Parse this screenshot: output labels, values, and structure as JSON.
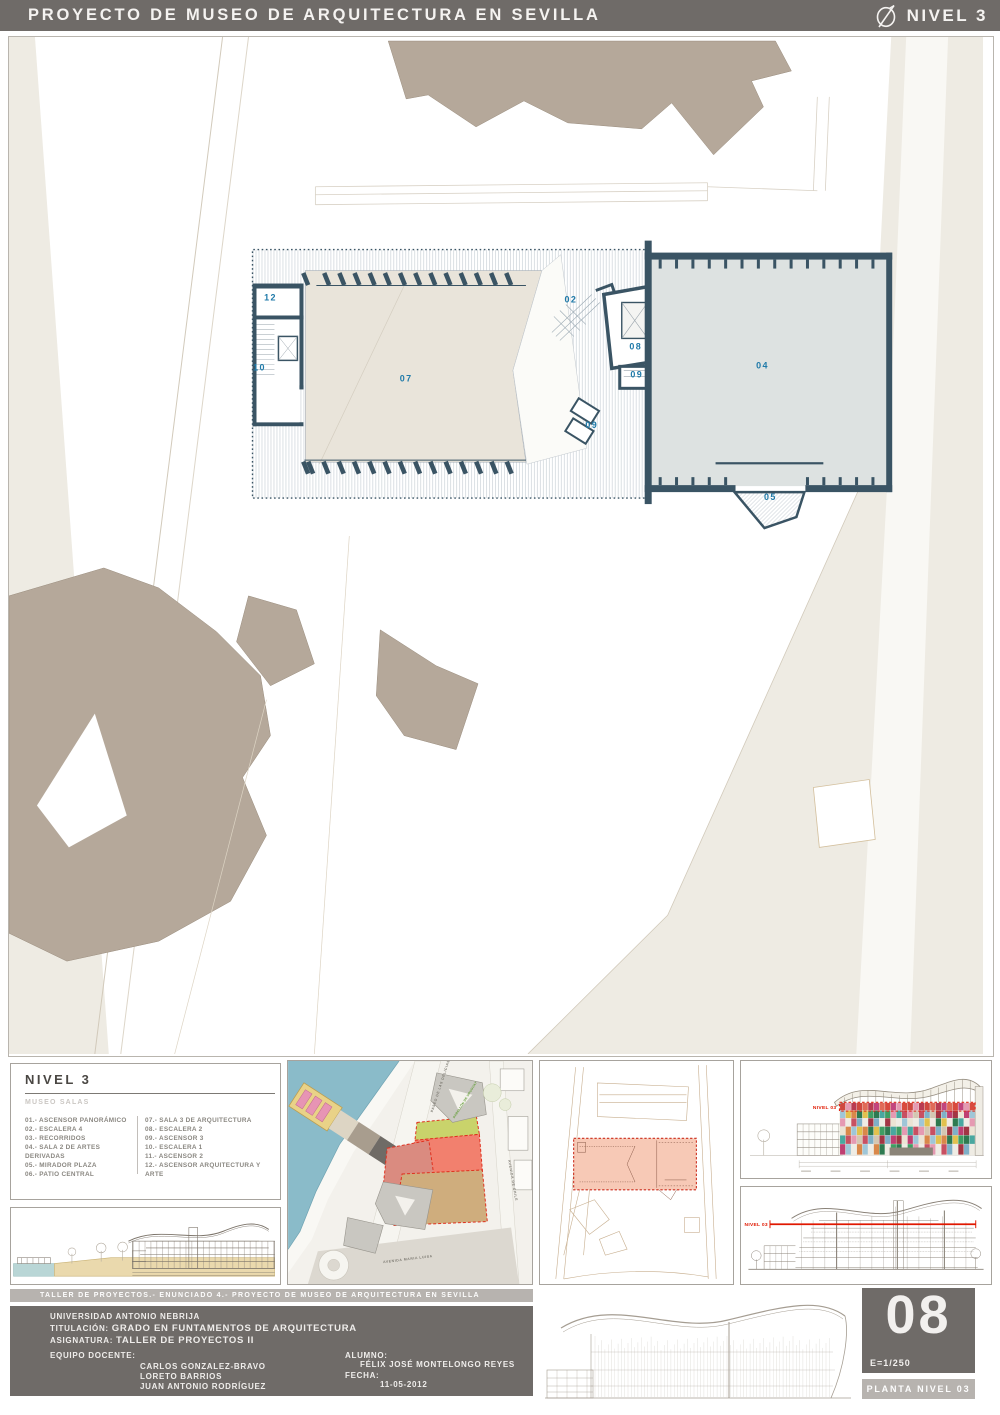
{
  "header": {
    "title": "PROYECTO DE MUSEO DE ARQUITECTURA EN SEVILLA",
    "level": "NIVEL 3"
  },
  "plan": {
    "room_labels": [
      {
        "t": "12",
        "x": 262,
        "y": 264
      },
      {
        "t": "10",
        "x": 251,
        "y": 334
      },
      {
        "t": "07",
        "x": 398,
        "y": 345
      },
      {
        "t": "02",
        "x": 563,
        "y": 266
      },
      {
        "t": "08",
        "x": 628,
        "y": 313
      },
      {
        "t": "09",
        "x": 629,
        "y": 341
      },
      {
        "t": "09",
        "x": 584,
        "y": 392
      },
      {
        "t": "04",
        "x": 755,
        "y": 332
      },
      {
        "t": "05",
        "x": 763,
        "y": 464
      }
    ]
  },
  "legend": {
    "title": "NIVEL 3",
    "subtitle": "MUSEO SALAS",
    "items_left": [
      "01.- ASCENSOR PANORÁMICO",
      "02.- ESCALERA 4",
      "03.- RECORRIDOS",
      "04.- SALA 2 DE ARTES DERIVADAS",
      "05.- MIRADOR PLAZA",
      "06.- PATIO CENTRAL"
    ],
    "items_right": [
      "07.- SALA 3 DE ARQUITECTURA",
      "08.- ESCALERA 2",
      "09.- ASCENSOR 3",
      "10.- ESCALERA 1",
      "11.- ASCENSOR 2",
      "12.- ASCENSOR ARQUITECTURA Y ARTE"
    ]
  },
  "map": {
    "streets": {
      "paseo": "PASEO DE LAS DELICIAS",
      "avenida_maria_luisa": "AVENIDA MARIA LUISA",
      "avenida_chile": "AVENIDA DE CHILE"
    },
    "building_label": "PABELLÓN DE URUGUAY"
  },
  "elevation_panel": {
    "level_marker": "NIVEL 03",
    "marker_color": "#e02818",
    "facade_palette": [
      "#c85062",
      "#e59ab2",
      "#49a8a0",
      "#3f9e63",
      "#2e7a50",
      "#e2c14e",
      "#d9884a",
      "#9fc6d8",
      "#ece4d4",
      "#bf3f72",
      "#a23644",
      "#7fb0c8",
      "#d4c7b2"
    ],
    "facade_top_palette": [
      "#cf4840",
      "#b93b52",
      "#e06a58",
      "#c2457e",
      "#d84a3e",
      "#e59ab2"
    ]
  },
  "section_panel": {
    "level_marker": "NIVEL 03",
    "marker_color": "#e01800"
  },
  "footer": {
    "strip_title": "TALLER DE PROYECTOS.- ENUNCIADO 4.- PROYECTO DE MUSEO DE ARQUITECTURA EN SEVILLA",
    "university": "UNIVERSIDAD ANTONIO NEBRIJA",
    "degree_label": "TITULACIÓN:",
    "degree": "GRADO EN FUNTAMENTOS DE ARQUITECTURA",
    "subject_label": "ASIGNATURA:",
    "subject": "TALLER DE PROYECTOS II",
    "team_label": "EQUIPO DOCENTE:",
    "team": [
      "CARLOS GONZALEZ-BRAVO",
      "LORETO BARRIOS",
      "JUAN ANTONIO RODRÍGUEZ"
    ],
    "student_label": "ALUMNO:",
    "student": "FÉLIX JOSÉ MONTELONGO REYES",
    "date_label": "FECHA:",
    "date": "11-05-2012",
    "sheet_number": "08",
    "scale": "E=1/250",
    "sheet_title": "PLANTA NIVEL 03"
  },
  "colors": {
    "wall": "#3a5464",
    "label_blue": "#1f7aa9",
    "room_fill": "#e9e4da",
    "hall_fill": "#dde2e1",
    "street_fill": "#eeebe3",
    "building_tan": "#b5a89a",
    "bar_dark": "#6f6b68",
    "bar_light": "#b7b3af",
    "ground": "#ead9ad",
    "water": "#8abbc9",
    "highlight_red": "#e0301e",
    "keyplan_fill": "#f7c9b6"
  }
}
